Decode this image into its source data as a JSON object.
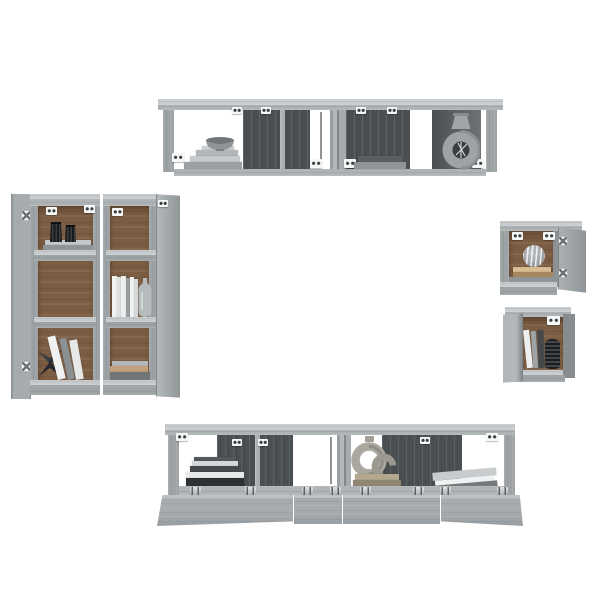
{
  "image": {
    "kind": "product-photo",
    "subject": "8-piece wall-mounted TV cabinet set, grey sonoma wood look, staged with books and vases",
    "background": "#ffffff",
    "pieces_visible": 8
  },
  "colors": {
    "cabinet": "#9ea3a6",
    "cabinet_light": "#c8ccce",
    "cabinet_mid": "#aeb3b6",
    "cabinet_dark": "#7f8588",
    "dark_back_panel": "#4a4f52",
    "brown_back_panel": "#7b5d43",
    "hardware_white": "#f6f7f7",
    "book_white": "#eef0f0",
    "book_gray": "#8f9497",
    "book_dark": "#303437",
    "book_tan": "#c0a17a",
    "decor_black": "#222527",
    "decor_gray": "#a2a7ab",
    "decor_beige": "#a8a49b",
    "background_white": "#ffffff"
  },
  "units": {
    "top_shelf_pair": {
      "label": "Two joined horizontal wall cabinets with four open compartments",
      "compartments": 4,
      "items": [
        "grey bowl on stepped stack of books",
        "stack of grey books",
        "round vase with cut-out centre holding dark twigs"
      ]
    },
    "tall_cabinet_left": {
      "label": "Tall vertical wall cabinet, door open to the left, three compartments",
      "compartments": 3,
      "items": [
        "two black ribbed vases on stacked books",
        "dark folded-paper decoration",
        "leaning books"
      ]
    },
    "tall_cabinet_right": {
      "label": "Tall vertical wall cabinet, door open to the right, three compartments",
      "compartments": 3,
      "items": [
        "row of standing white books",
        "grey bottle vase",
        "flat stack of books"
      ]
    },
    "small_cabinet_upper": {
      "label": "Small square wall cabinet, door open to the right",
      "compartments": 1,
      "items": [
        "striped round vase on flat beige books"
      ]
    },
    "small_cabinet_lower": {
      "label": "Small square wall cabinet, door open to the front left",
      "compartments": 1,
      "items": [
        "leaning books",
        "black ribbed vase"
      ]
    },
    "bottom_cabinet_pair": {
      "label": "Two joined horizontal cabinets with fold-down doors open",
      "compartments": 4,
      "items": [
        "stack of dark books with white pages",
        "ring-shaped sculpture on stacked books",
        "grey binder lying at an angle"
      ]
    }
  }
}
